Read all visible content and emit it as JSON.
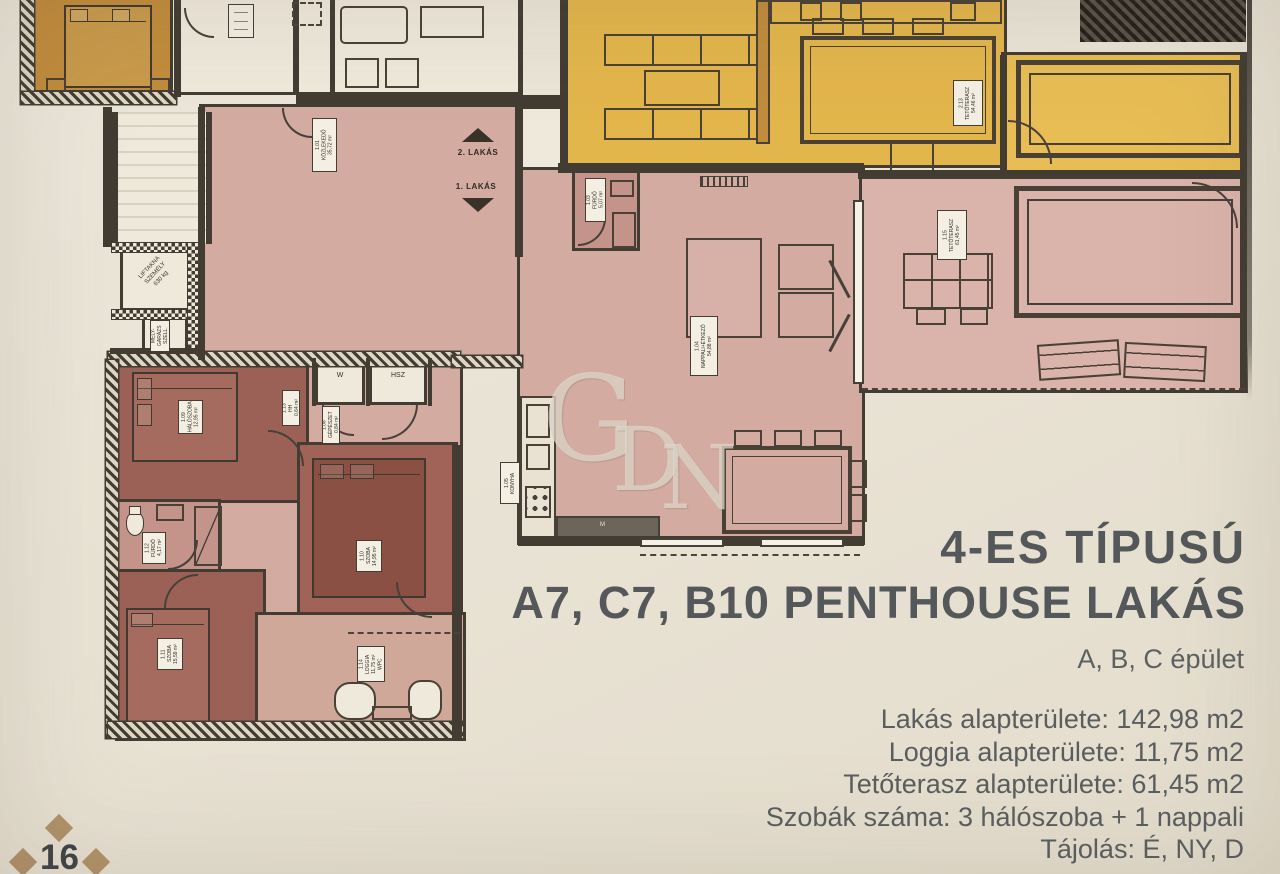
{
  "page": {
    "number": "16",
    "watermark_letters": [
      "G",
      "D",
      "N"
    ]
  },
  "header": {
    "title_line1": "4-ES TÍPUSÚ",
    "title_line2": "A7, C7, B10 PENTHOUSE LAKÁS",
    "subtitle": "A, B, C épület"
  },
  "details": {
    "lines": [
      "Lakás alapterülete: 142,98 m2",
      "Loggia alapterülete: 11,75 m2",
      "Tetőterasz alapterülete: 61,45 m2",
      "Szobák száma:  3 hálószoba + 1 nappali",
      "Tájolás: É, NY, D"
    ]
  },
  "floorplan": {
    "stairs": {
      "up": "2. LAKÁS",
      "down": "1. LAKÁS"
    },
    "labels": {
      "kozlekedo": "1.01\nKÖZLEKEDŐ\n35,72 m²",
      "furdo_1": "1.03\nFÜRDŐ\n5,07 m²",
      "nappali": "1.04\nNAPPALI+ÉTKEZŐ\n54,88 m²",
      "konyha": "1.05\nKONYHA",
      "gepeszet": "1.08\nGÉPÉSZET\n0,84 m²",
      "halo": "1.09\nHÁLÓSZOBA\n12,95 m²",
      "szoba_2": "1.10\nSZOBA\n14,95 m²",
      "szoba_3": "1.11\nSZOBA\n15,59 m²",
      "furdo_2": "1.12\nFÜRDŐ\n4,17 m²",
      "hh": "1.13\nHH\n0,64 m²",
      "loggia": "1.14\nLOGGIA\n11,75 m²\nWPC",
      "tetoterasz_1": "1.15\nTETŐTERASZ\n61,45 m²",
      "tetoterasz_2": "2.13\nTETŐTERASZ\n54,46 m²",
      "wc": "W",
      "hsz": "HSZ",
      "lift": "LIFTAKNA\nSZEMÉLY\n630 kg",
      "melygarazs": "MÉLY-\nGARÁZS\nSZELL.",
      "dishwasher": "M"
    },
    "colors": {
      "orange": "#c18c3c",
      "yellow": "#e3b64c",
      "pink": "#d4aba1",
      "terrace_pink": "#dab3aa",
      "maroon": "#9c6156",
      "bed_maroon": "#8a5044",
      "bath_mauve": "#c4948a",
      "loggia_pink": "#d0a89a",
      "wall": "#423c33",
      "cream": "#efe9dc",
      "diamond": "#b1926a",
      "title_text": "#54585a"
    }
  }
}
